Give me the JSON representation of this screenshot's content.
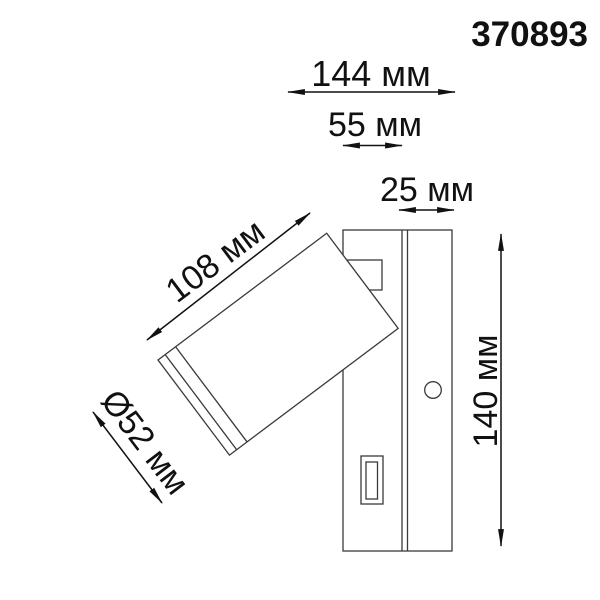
{
  "part_number": "370893",
  "dimensions": {
    "overall_width": "144 мм",
    "housing_width": "55 мм",
    "base_depth": "25 мм",
    "spot_length": "108 мм",
    "spot_diameter": "Ø52 мм",
    "overall_height": "140 мм"
  },
  "colors": {
    "background": "#ffffff",
    "drawing_line": "#3a3a3a",
    "dimension_line": "#111111",
    "text": "#111111"
  }
}
